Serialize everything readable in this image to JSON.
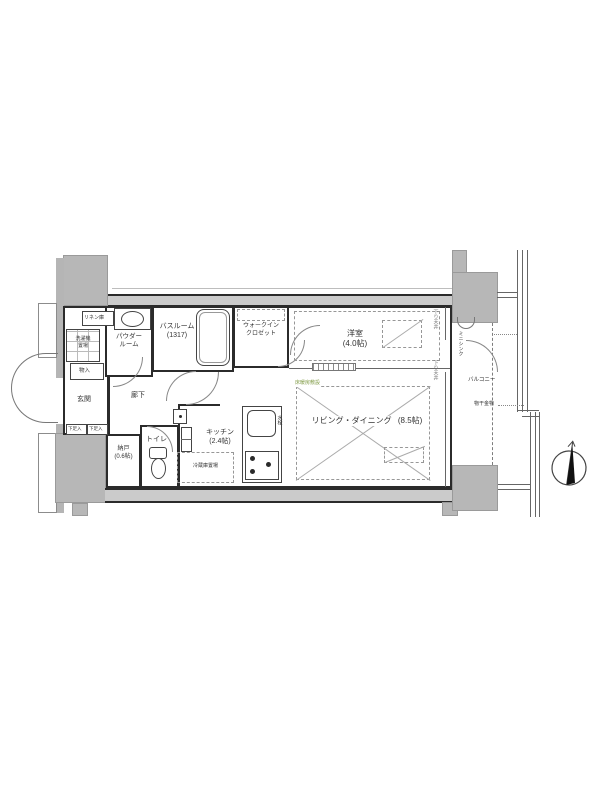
{
  "meta": {
    "type": "apartment-floor-plan"
  },
  "colors": {
    "wall": "#2b2b2b",
    "concrete_fill": "#b7b7b7",
    "wall_band_fill": "#cbcbcb",
    "dashed_line": "#979797",
    "floor_heating_text": "#7f9a44"
  },
  "rooms": {
    "living": {
      "name": "リビング・ダイニング",
      "size": "(8.5帖)"
    },
    "western": {
      "name": "洋室",
      "size": "(4.0帖)"
    },
    "kitchen": {
      "name": "キッチン",
      "size": "(2.4帖)"
    },
    "bathroom": {
      "name": "バスルーム",
      "size": "(1317)"
    },
    "powder_room": {
      "name_line1": "パウダー",
      "name_line2": "ルーム"
    },
    "walk_in_closet": {
      "name_line1": "ウォークイン",
      "name_line2": "クロゼット"
    },
    "toilet": {
      "name": "トイレ"
    },
    "storage_room": {
      "name": "納戸",
      "size": "(0.6帖)"
    },
    "entrance": {
      "name": "玄関"
    },
    "corridor": {
      "name": "廊下"
    },
    "balcony": {
      "name": "バルコニー"
    }
  },
  "labels": {
    "linen": "リネン庫",
    "washer_line1": "洗濯機",
    "washer_line2": "置場",
    "closet_upper": "物入",
    "shoe_box_left": "下足入",
    "shoe_box_right": "下足入",
    "fridge": "冷蔵庫置場",
    "mini_sink_line1": "ミニ",
    "mini_sink_line2": "シンク",
    "laundry_hardware": "物干金物",
    "floor_heating": "床暖房敷設",
    "faucet": "水栓",
    "dropped_ceiling_upper": "下り天井",
    "dropped_ceiling_lower": "下り天井"
  },
  "compass": {
    "direction": "N"
  }
}
